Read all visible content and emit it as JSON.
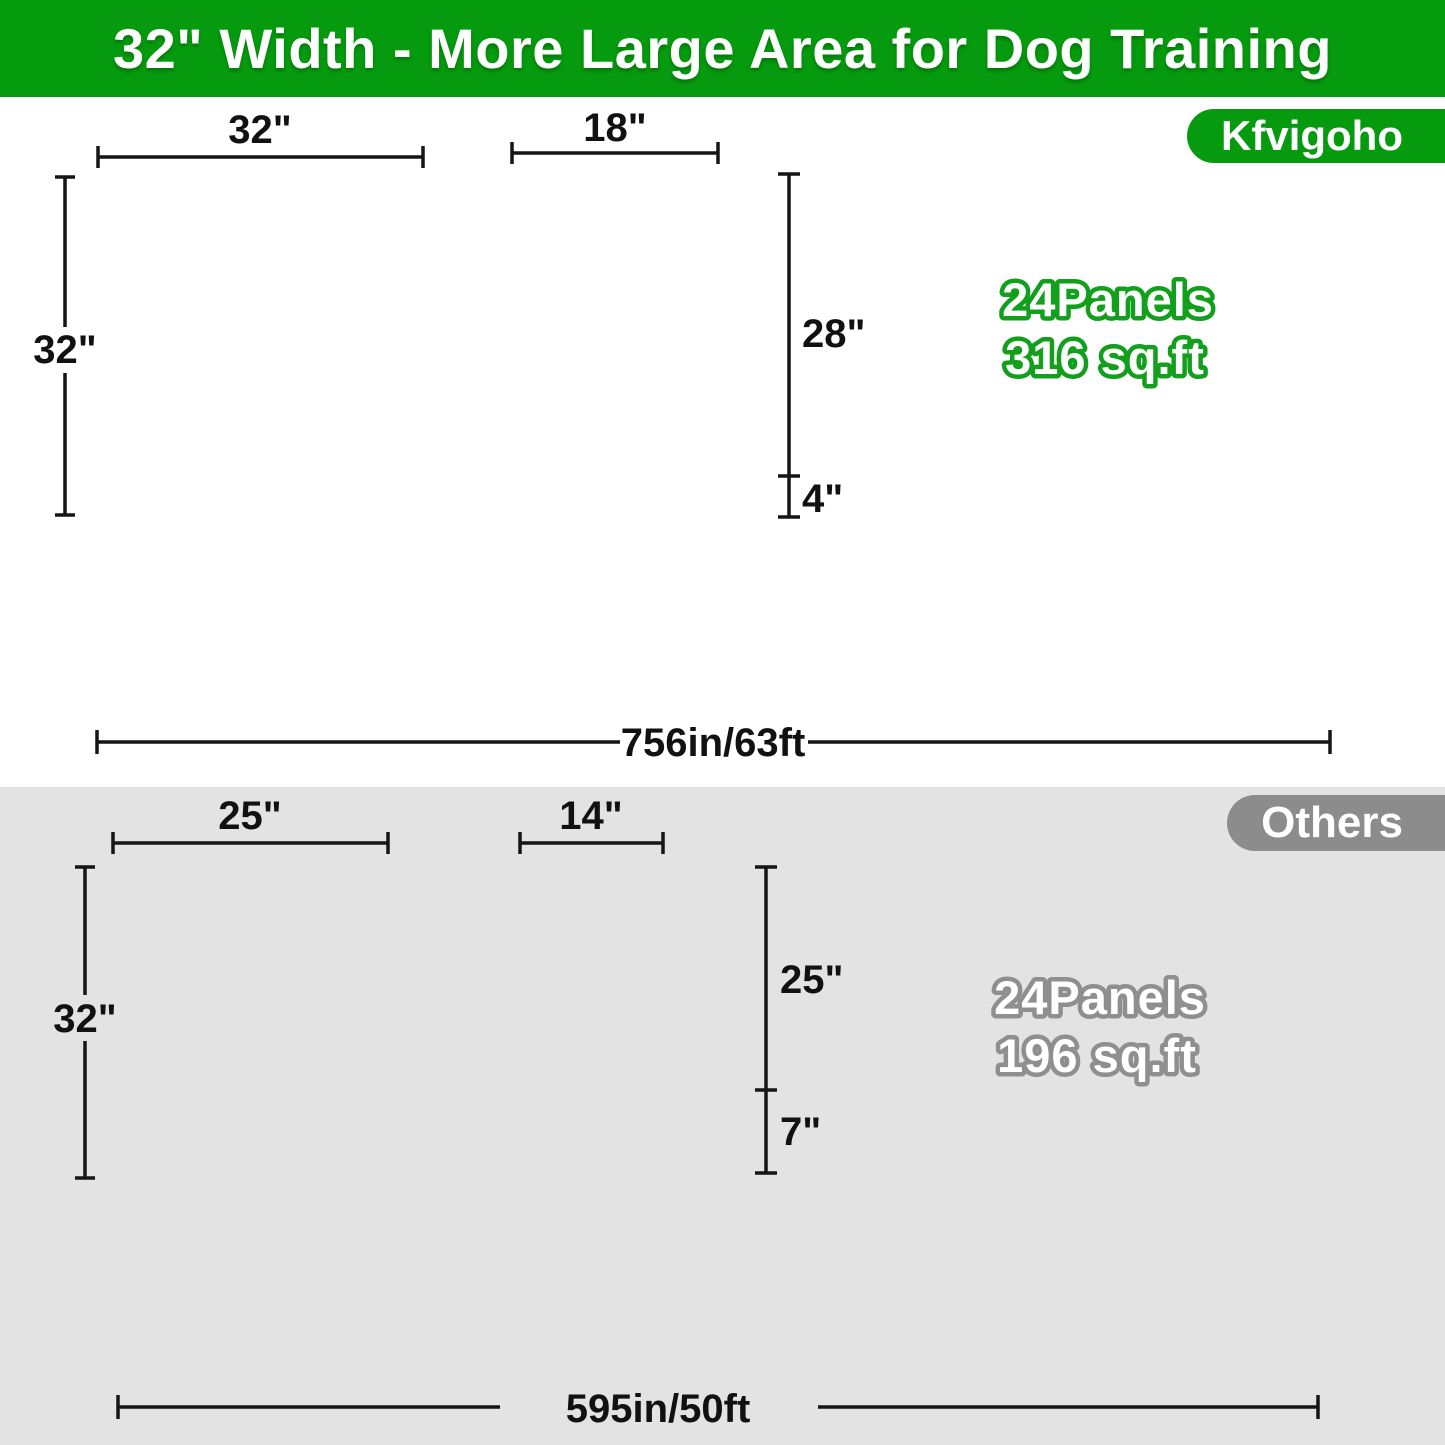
{
  "banner": {
    "title": "32\" Width - More Large Area for Dog Training"
  },
  "brand": {
    "badge": "Kfvigoho",
    "panel": {
      "width_label": "32\"",
      "height_label": "32\""
    },
    "gate": {
      "width_label": "18\"",
      "height_label": "28\"",
      "bottom_label": "4\""
    },
    "pen": {
      "line1": "24Panels",
      "line2": "316 sq.ft"
    },
    "row": {
      "length_label": "756in/63ft"
    }
  },
  "others": {
    "badge": "Others",
    "panel": {
      "width_label": "25\"",
      "height_label": "32\""
    },
    "gate": {
      "width_label": "14\"",
      "height_label": "25\"",
      "bottom_label": "7\""
    },
    "pen": {
      "line1": "24Panels",
      "line2": "196 sq.ft"
    },
    "row": {
      "length_label": "595in/50ft"
    }
  },
  "colors": {
    "banner_green": "#069a0e",
    "brand_badge_green": "#069a0e",
    "others_badge_gray": "#8c8c8c",
    "others_section_gray": "#e3e3e3",
    "pen_text_outline_green": "#12a01c",
    "pen_text_outline_gray": "#8f8f8f",
    "fence_dark": "#222222",
    "fence_gray": "#3c3c3c"
  }
}
